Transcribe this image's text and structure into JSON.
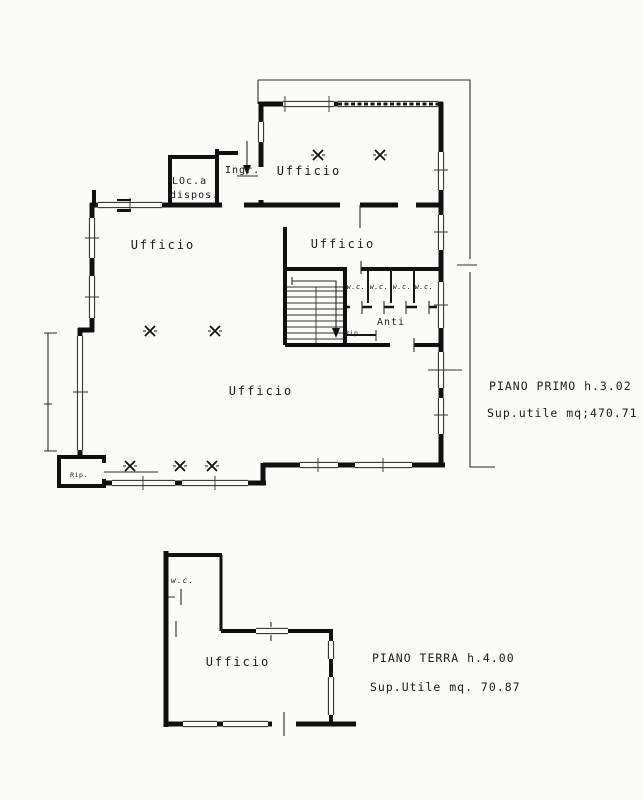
{
  "page": {
    "background": "#fbfbf9",
    "ink": "#1a1a1a"
  },
  "first_floor": {
    "labels": {
      "ufficio_top": "Ufficio",
      "ingresso": "Ingr.",
      "loc_dispos_line1": "LOc.a",
      "loc_dispos_line2": "dispos.",
      "ufficio_left": "Ufficio",
      "ufficio_middle": "Ufficio",
      "wc_1": "w.c.",
      "wc_2": "w.c.",
      "wc_3": "w.c.",
      "wc_4": "w.c.",
      "anti": "Anti",
      "rip_under_stair": "Rip.",
      "ufficio_main": "Ufficio",
      "rip_corner": "Rip."
    },
    "caption": {
      "title": "PIANO PRIMO h.3.02",
      "area": "Sup.utile mq;470.71"
    }
  },
  "ground_floor": {
    "labels": {
      "wc": "w.c.",
      "ufficio": "Ufficio"
    },
    "caption": {
      "title": "PIANO TERRA h.4.00",
      "area": "Sup.Utile mq. 70.87"
    }
  }
}
